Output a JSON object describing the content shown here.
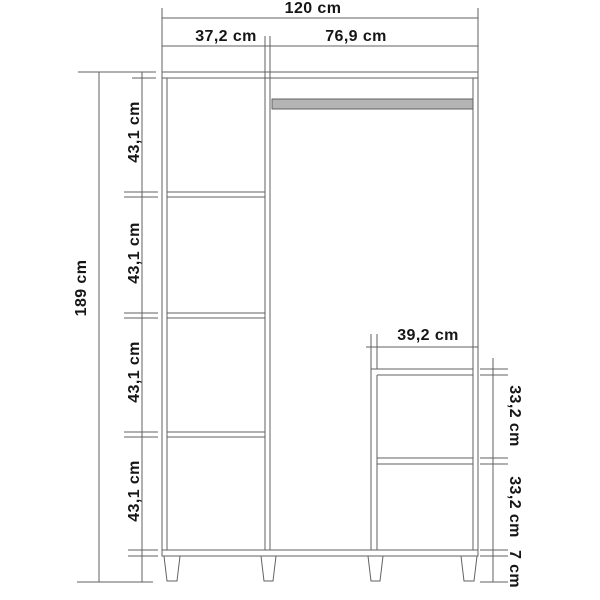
{
  "drawing": {
    "type": "wardrobe-dimension-diagram",
    "unit": "cm",
    "colors": {
      "line": "#616161",
      "text": "#161616",
      "rail": "#b4b4b4",
      "background": "#ffffff"
    },
    "labels": {
      "total_width": "120 cm",
      "left_section_width": "37,2 cm",
      "right_section_width": "76,9 cm",
      "total_height": "189 cm",
      "compartment_1_height": "43,1 cm",
      "compartment_2_height": "43,1 cm",
      "compartment_3_height": "43,1 cm",
      "compartment_4_height": "43,1 cm",
      "lower_cabinet_width": "39,2 cm",
      "lower_cabinet_upper_height": "33,2 cm",
      "lower_cabinet_lower_height": "33,2 cm",
      "leg_height": "7 cm"
    }
  }
}
